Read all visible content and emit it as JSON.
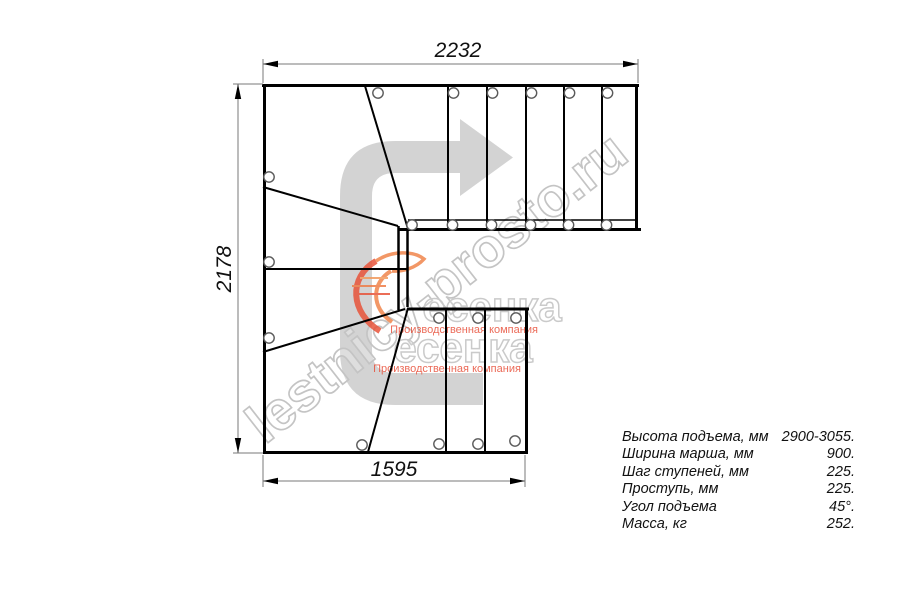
{
  "watermarks": {
    "diagonal_url": "lestnicy-prosto.ru",
    "logo_name": "есенка",
    "logo_tagline": "Производственная компания"
  },
  "dimensions": {
    "top_width_mm": "2232",
    "left_height_mm": "2178",
    "bottom_width_mm": "1595"
  },
  "specs": {
    "rows": [
      {
        "label": "Высота подъема, мм",
        "value": "2900-3055."
      },
      {
        "label": "Ширина марша, мм",
        "value": "900."
      },
      {
        "label": "Шаг ступеней, мм",
        "value": "225."
      },
      {
        "label": "Проступь, мм",
        "value": "225."
      },
      {
        "label": "Угол подъема",
        "value": "45°."
      },
      {
        "label": "Масса, кг",
        "value": "252."
      }
    ]
  }
}
